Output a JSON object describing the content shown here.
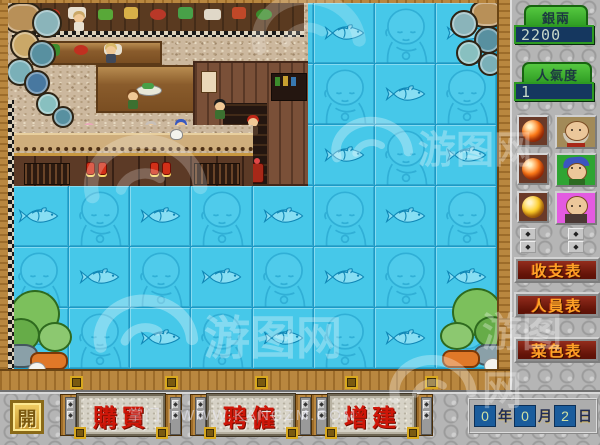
{
  "hud": {
    "money_label": "銀兩",
    "money_value": "2200",
    "popularity_label": "人氣度",
    "popularity_value": "1"
  },
  "map": {
    "cols": 8,
    "rows": 6,
    "tile_motifs": [
      "head-icon",
      "fish-icon"
    ],
    "accent_colors": {
      "tile": "#46c8e9",
      "grid_line": "#1b9ac6",
      "frame_wood": "#b9873f"
    }
  },
  "sidebar": {
    "staff_rows": [
      {
        "orb": "orange-orb-icon",
        "orb_color": "#ff7b18",
        "orb_shade": "#b02c04",
        "portrait": "elder"
      },
      {
        "orb": "orange-orb-icon",
        "orb_color": "#ff7b18",
        "orb_shade": "#b02c04",
        "portrait": "youth"
      },
      {
        "orb": "yellow-orb-icon",
        "orb_color": "#ffd029",
        "orb_shade": "#c08808",
        "portrait": "bald"
      }
    ],
    "report_buttons": [
      {
        "name": "income-expense-report-button",
        "label": "收支表"
      },
      {
        "name": "staff-report-button",
        "label": "人員表"
      },
      {
        "name": "menu-report-button",
        "label": "菜色表"
      }
    ],
    "spinner_glyph": "◆"
  },
  "bottom_bar": {
    "idle_button_label": "開",
    "action_buttons": [
      {
        "name": "buy-button",
        "label": "購買"
      },
      {
        "name": "hire-button",
        "label": "聘僱"
      },
      {
        "name": "expand-button",
        "label": "增建"
      }
    ],
    "date": {
      "segments": [
        {
          "name": "year-value",
          "kind": "value",
          "text": "0"
        },
        {
          "name": "year-unit",
          "kind": "unit",
          "text": "年"
        },
        {
          "name": "month-value",
          "kind": "value",
          "text": "0"
        },
        {
          "name": "month-unit",
          "kind": "unit",
          "text": "月"
        },
        {
          "name": "day-value",
          "kind": "value",
          "text": "2"
        },
        {
          "name": "day-unit",
          "kind": "unit",
          "text": "日"
        }
      ]
    }
  },
  "watermark": {
    "logo_text": "游图网",
    "footer_text": "掌门 | WWW.KANGZM.COM"
  }
}
